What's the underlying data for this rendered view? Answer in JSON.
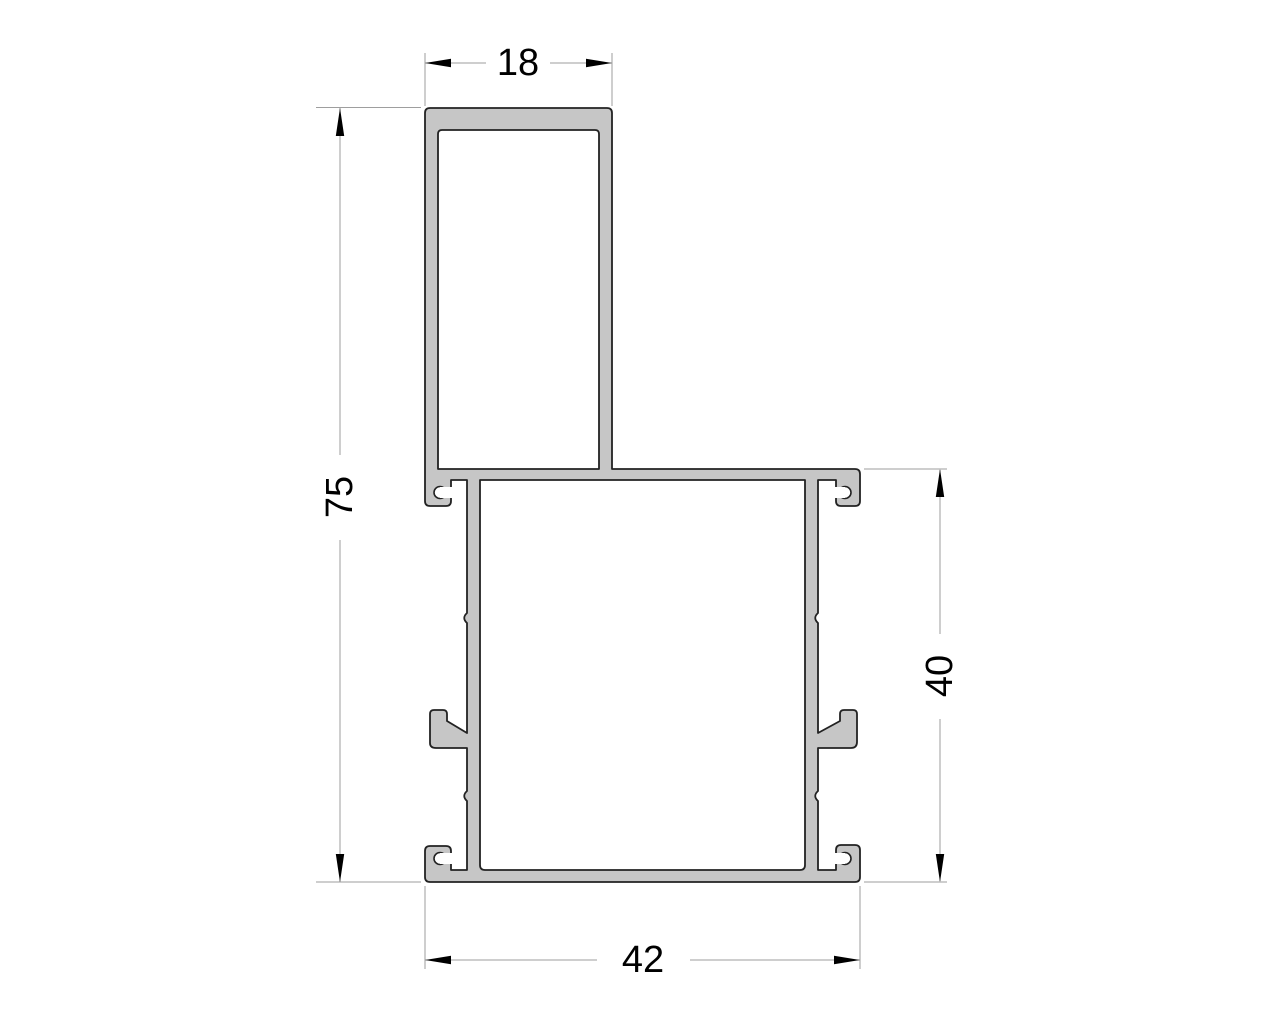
{
  "page": {
    "background_color": "#ffffff"
  },
  "drawing": {
    "subject": "aluminium-profile-cross-section",
    "profile_fill_color": "#c6c6c6",
    "profile_outline_color": "#222222",
    "dimension_line_color": "#9e9e9e",
    "dimension_text_color": "#000000",
    "dimensions": {
      "top_width": "18",
      "overall_height": "75",
      "right_height": "40",
      "bottom_width": "42"
    }
  }
}
